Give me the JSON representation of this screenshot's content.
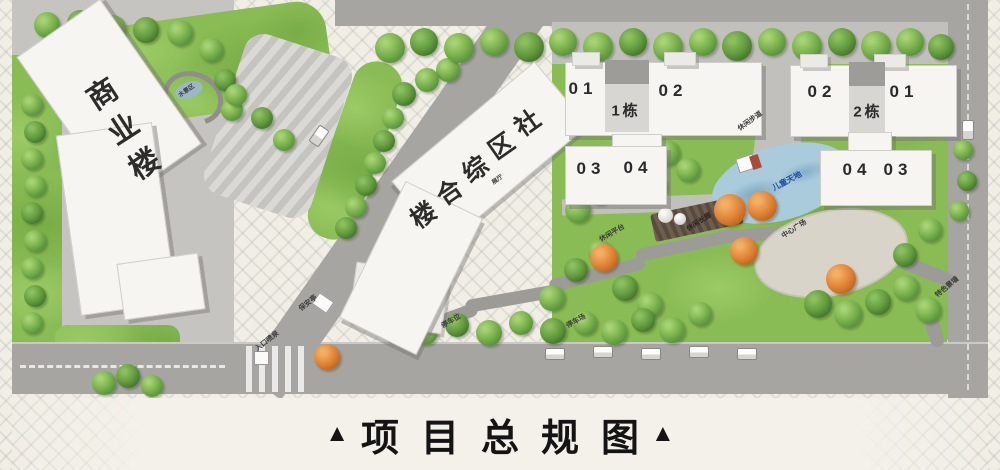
{
  "title_bar": {
    "marker_left": "▲",
    "text": "项目总规图",
    "marker_right": "▲"
  },
  "buildings": {
    "commercial": {
      "label": "商业楼"
    },
    "community": {
      "label": "社区综合楼"
    },
    "tower1": {
      "name": "1栋",
      "units": {
        "tl": "01",
        "tr": "02",
        "bl": "03",
        "br": "04"
      }
    },
    "tower2": {
      "name": "2栋",
      "units": {
        "tl": "02",
        "tr": "01",
        "bl": "04",
        "br": "03"
      }
    }
  },
  "site_labels": {
    "water_feature": "水景区",
    "exhibition": "展厅",
    "security_booth": "保安亭",
    "entrance_fountain": "入口喷泉",
    "parking_spaces": "停车位",
    "parking_lot": "停车场",
    "leisure_platform": "休闲平台",
    "leisure_corridor": "休闲长廊",
    "children_area": "儿童天地",
    "leisure_path": "休闲步道",
    "central_plaza": "中心广场",
    "feature_wall": "特色景墙"
  },
  "colors": {
    "background": "#f1eee6",
    "lawn": "#8abc55",
    "road": "#a7a5a2",
    "plaza": "#c6c4c0",
    "building": "#f6f5f1",
    "pond": "#a9cbdc",
    "tree_green": "#54903a",
    "tree_orange": "#dd8033",
    "children_label": "#1d4e9e",
    "title": "#141414"
  }
}
